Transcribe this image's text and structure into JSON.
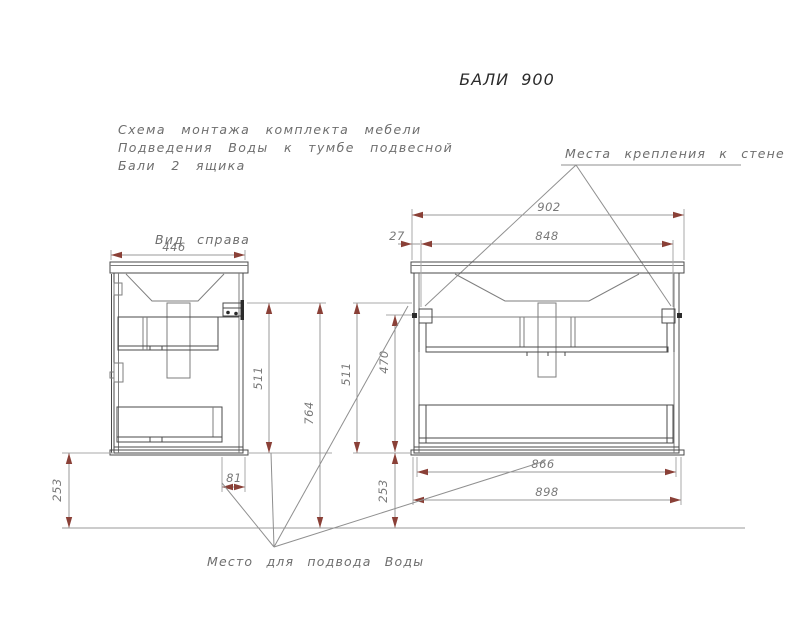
{
  "title": "БАЛИ 900",
  "description": {
    "line1": "Схема монтажа комплекта мебели",
    "line2": "Подведения Воды к тумбе подвесной",
    "line3": "Бали 2 ящика"
  },
  "labels": {
    "wall_mount": "Места крепления к стене",
    "side_view": "Вид справа",
    "water_supply": "Место для подвода Воды"
  },
  "dimensions": {
    "side_width": "446",
    "top_width": "902",
    "bracket_offset": "27",
    "bracket_span": "848",
    "side_height": "511",
    "total_height": "764",
    "front_height": "511",
    "inner_height": "470",
    "clearance_left": "253",
    "clearance_right": "253",
    "drain_offset": "81",
    "inner_width": "866",
    "body_width": "898"
  },
  "colors": {
    "outline": "#4a4a4a",
    "dimension_line": "#9a9a9a",
    "arrow": "#8a4037",
    "dim_text": "#787878",
    "label_text": "#6e6e6e",
    "title_text": "#2b2b2b",
    "background": "#ffffff"
  }
}
